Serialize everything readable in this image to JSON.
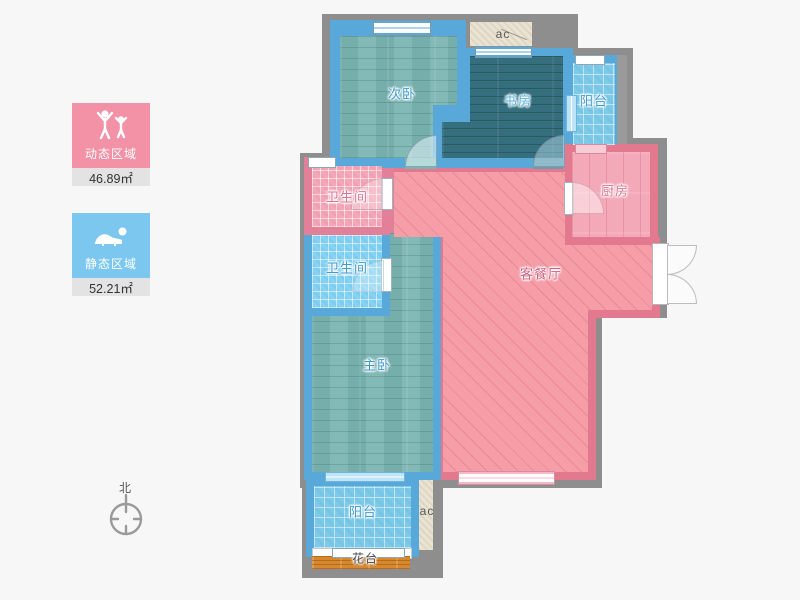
{
  "legend": {
    "dynamic": {
      "label": "动态区域",
      "area": "46.89㎡",
      "color": "#f392a6",
      "icon": "people-cheering-icon"
    },
    "static": {
      "label": "静态区域",
      "area": "52.21㎡",
      "color": "#7cc7f0",
      "icon": "person-resting-icon"
    }
  },
  "compass": {
    "label": "北"
  },
  "rooms": {
    "secondary_bedroom": {
      "label": "次卧"
    },
    "study": {
      "label": "书房"
    },
    "balcony_top": {
      "label": "阳台"
    },
    "kitchen": {
      "label": "厨房"
    },
    "bathroom_upper": {
      "label": "卫生间"
    },
    "bathroom_lower": {
      "label": "卫生间"
    },
    "living_dining": {
      "label": "客餐厅"
    },
    "master_bedroom": {
      "label": "主卧"
    },
    "balcony_bottom": {
      "label": "阳台"
    },
    "flower_bed": {
      "label": "花台"
    },
    "ac_top": {
      "label": "ac"
    },
    "ac_bottom": {
      "label": "ac"
    }
  },
  "colors": {
    "background": "#f7f7f7",
    "outer_wall": "#8e8e8e",
    "blue_wall": "#58a9d9",
    "pink_wall": "#e2798f",
    "wood_floor": "#7cb5b2",
    "study_floor": "#356f7e",
    "balcony_tile": "#7ecbe9",
    "bath_pink_tile": "#f3a7b9",
    "bath_blue_tile": "#86d2f3",
    "living_floor": "#f69ea8",
    "kitchen_floor": "#f4a9b9",
    "flower_bed": "#d8882c",
    "ac_fill": "#eae3d2"
  }
}
